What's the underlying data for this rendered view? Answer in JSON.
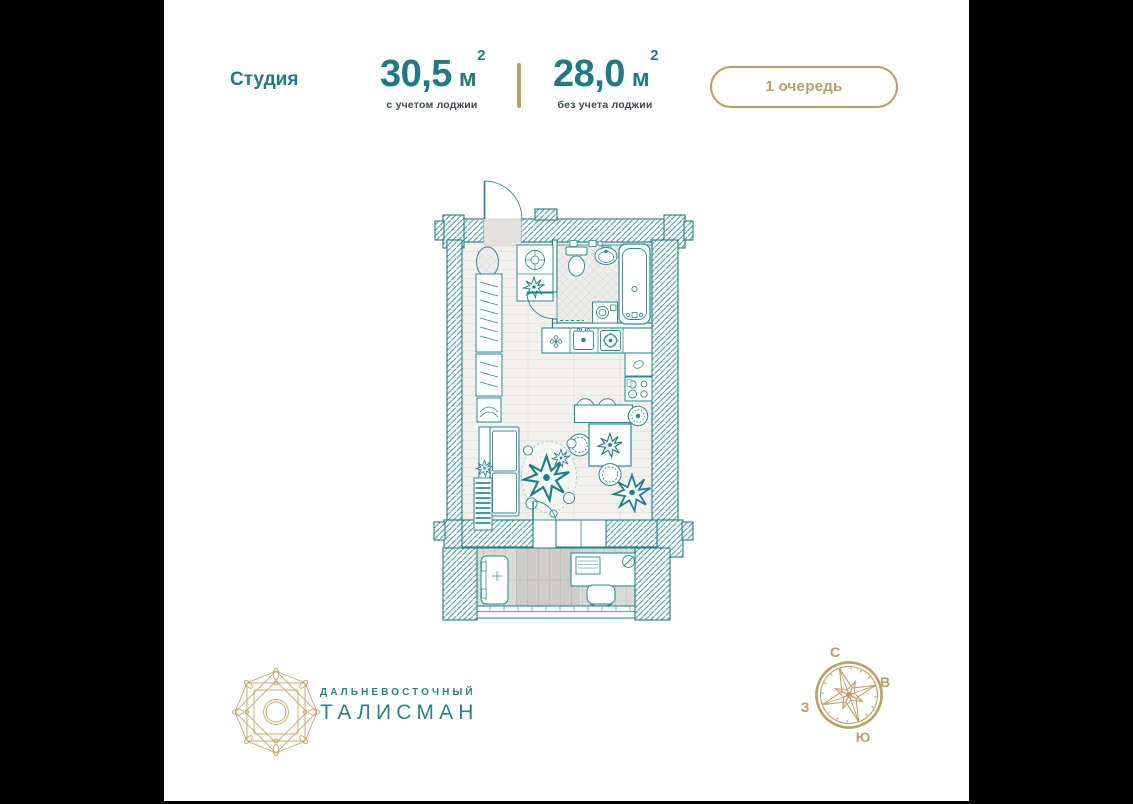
{
  "header": {
    "type_label": "Студия",
    "area_with_loggia": {
      "value": "30,5",
      "unit": "м",
      "sup": "2",
      "caption": "с учетом лоджии"
    },
    "area_without_loggia": {
      "value": "28,0",
      "unit": "м",
      "sup": "2",
      "caption": "без учета лоджии"
    },
    "phase_badge": "1 очередь"
  },
  "logo": {
    "line1": "ДАЛЬНЕВОСТОЧНЫЙ",
    "line2": "ТАЛИСМАН"
  },
  "compass": {
    "north": "С",
    "east": "В",
    "south": "Ю",
    "west": "З"
  },
  "icons": {
    "logo_emblem": "eight-point-star-emblem",
    "compass_rose": "compass-rose",
    "floor_plan": "studio-floor-plan-drawing"
  },
  "colors": {
    "teal_text": "#1E7B85",
    "plan_teal": "#1F7F89",
    "gold": "#BB9C63",
    "dark_caption": "#3D4A52",
    "background": "#FFFFFF",
    "letterbox": "#000000"
  }
}
